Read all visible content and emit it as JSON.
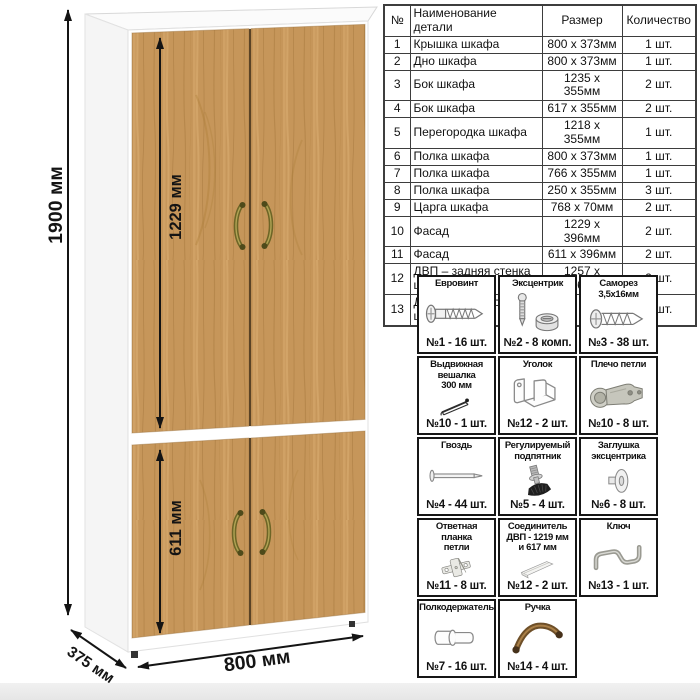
{
  "dimensions": {
    "height": "1900 мм",
    "upper_section": "1229 мм",
    "lower_section": "611 мм",
    "width": "800 мм",
    "depth": "375 мм"
  },
  "parts_table": {
    "headers": [
      "№",
      "Наименование детали",
      "Размер",
      "Количество"
    ],
    "rows": [
      {
        "num": "1",
        "name": "Крышка шкафа",
        "size": "800 х 373мм",
        "qty": "1 шт."
      },
      {
        "num": "2",
        "name": "Дно шкафа",
        "size": "800 х 373мм",
        "qty": "1 шт."
      },
      {
        "num": "3",
        "name": "Бок шкафа",
        "size": "1235 х 355мм",
        "qty": "2 шт."
      },
      {
        "num": "4",
        "name": "Бок шкафа",
        "size": "617 х 355мм",
        "qty": "2 шт."
      },
      {
        "num": "5",
        "name": "Перегородка шкафа",
        "size": "1218 х 355мм",
        "qty": "1 шт."
      },
      {
        "num": "6",
        "name": "Полка шкафа",
        "size": "800 х 373мм",
        "qty": "1 шт."
      },
      {
        "num": "7",
        "name": "Полка шкафа",
        "size": "766 х 355мм",
        "qty": "1 шт."
      },
      {
        "num": "8",
        "name": "Полка шкафа",
        "size": "250 х 355мм",
        "qty": "3 шт."
      },
      {
        "num": "9",
        "name": "Царга шкафа",
        "size": "768 х 70мм",
        "qty": "2 шт."
      },
      {
        "num": "10",
        "name": "Фасад",
        "size": "1229 х 396мм",
        "qty": "2 шт."
      },
      {
        "num": "11",
        "name": "Фасад",
        "size": "611 х 396мм",
        "qty": "2 шт."
      },
      {
        "num": "12",
        "name": "ДВП – задняя стенка шкафа",
        "size": "1257 х 396мм",
        "qty": "2 шт."
      },
      {
        "num": "13",
        "name": "ДВП – задняя стенка шкафа",
        "size": "639 х 396мм",
        "qty": "2 шт."
      }
    ]
  },
  "hardware": {
    "items": [
      {
        "title": "Евровинт",
        "icon": "euro-screw-icon",
        "count": "№1 - 16 шт."
      },
      {
        "title": "Эксцентрик",
        "icon": "eccentric-cam-icon",
        "count": "№2 - 8 комп."
      },
      {
        "title": "Саморез\n3,5х16мм",
        "icon": "self-tapping-screw-icon",
        "count": "№3 - 38 шт."
      },
      {
        "title": "Выдвижная\nвешалка\n300 мм",
        "icon": "pullout-hanger-icon",
        "count": "№10 - 1 шт."
      },
      {
        "title": "Уголок",
        "icon": "corner-bracket-icon",
        "count": "№12 - 2 шт."
      },
      {
        "title": "Плечо петли",
        "icon": "hinge-arm-icon",
        "count": "№10 - 8 шт."
      },
      {
        "title": "Гвоздь",
        "icon": "nail-icon",
        "count": "№4 - 44 шт."
      },
      {
        "title": "Регулируемый\nподпятник",
        "icon": "adjustable-foot-icon",
        "count": "№5 - 4 шт."
      },
      {
        "title": "Заглушка\nэксцентрика",
        "icon": "cam-cover-icon",
        "count": "№6 - 8 шт."
      },
      {
        "title": "Ответная планка\nпетли",
        "icon": "hinge-plate-icon",
        "count": "№11 - 8 шт."
      },
      {
        "title": "Соединитель\nДВП - 1219 мм\nи 617 мм",
        "icon": "hdf-connector-icon",
        "count": "№12 - 2 шт."
      },
      {
        "title": "Ключ",
        "icon": "hex-key-icon",
        "count": "№13 - 1 шт."
      },
      {
        "title": "Полкодержатель",
        "icon": "shelf-pin-icon",
        "count": "№7 - 16 шт."
      },
      {
        "title": "Ручка",
        "icon": "handle-icon",
        "count": "№14 - 4 шт."
      }
    ]
  },
  "colors": {
    "wood": "#c6965a",
    "wood_dark": "#a87a3e",
    "wood_light": "#dcae72",
    "cabinet_body": "#ffffff",
    "dimension_lines": "#141414",
    "handle": "#7c7a33",
    "hardware_border": "#161616"
  }
}
